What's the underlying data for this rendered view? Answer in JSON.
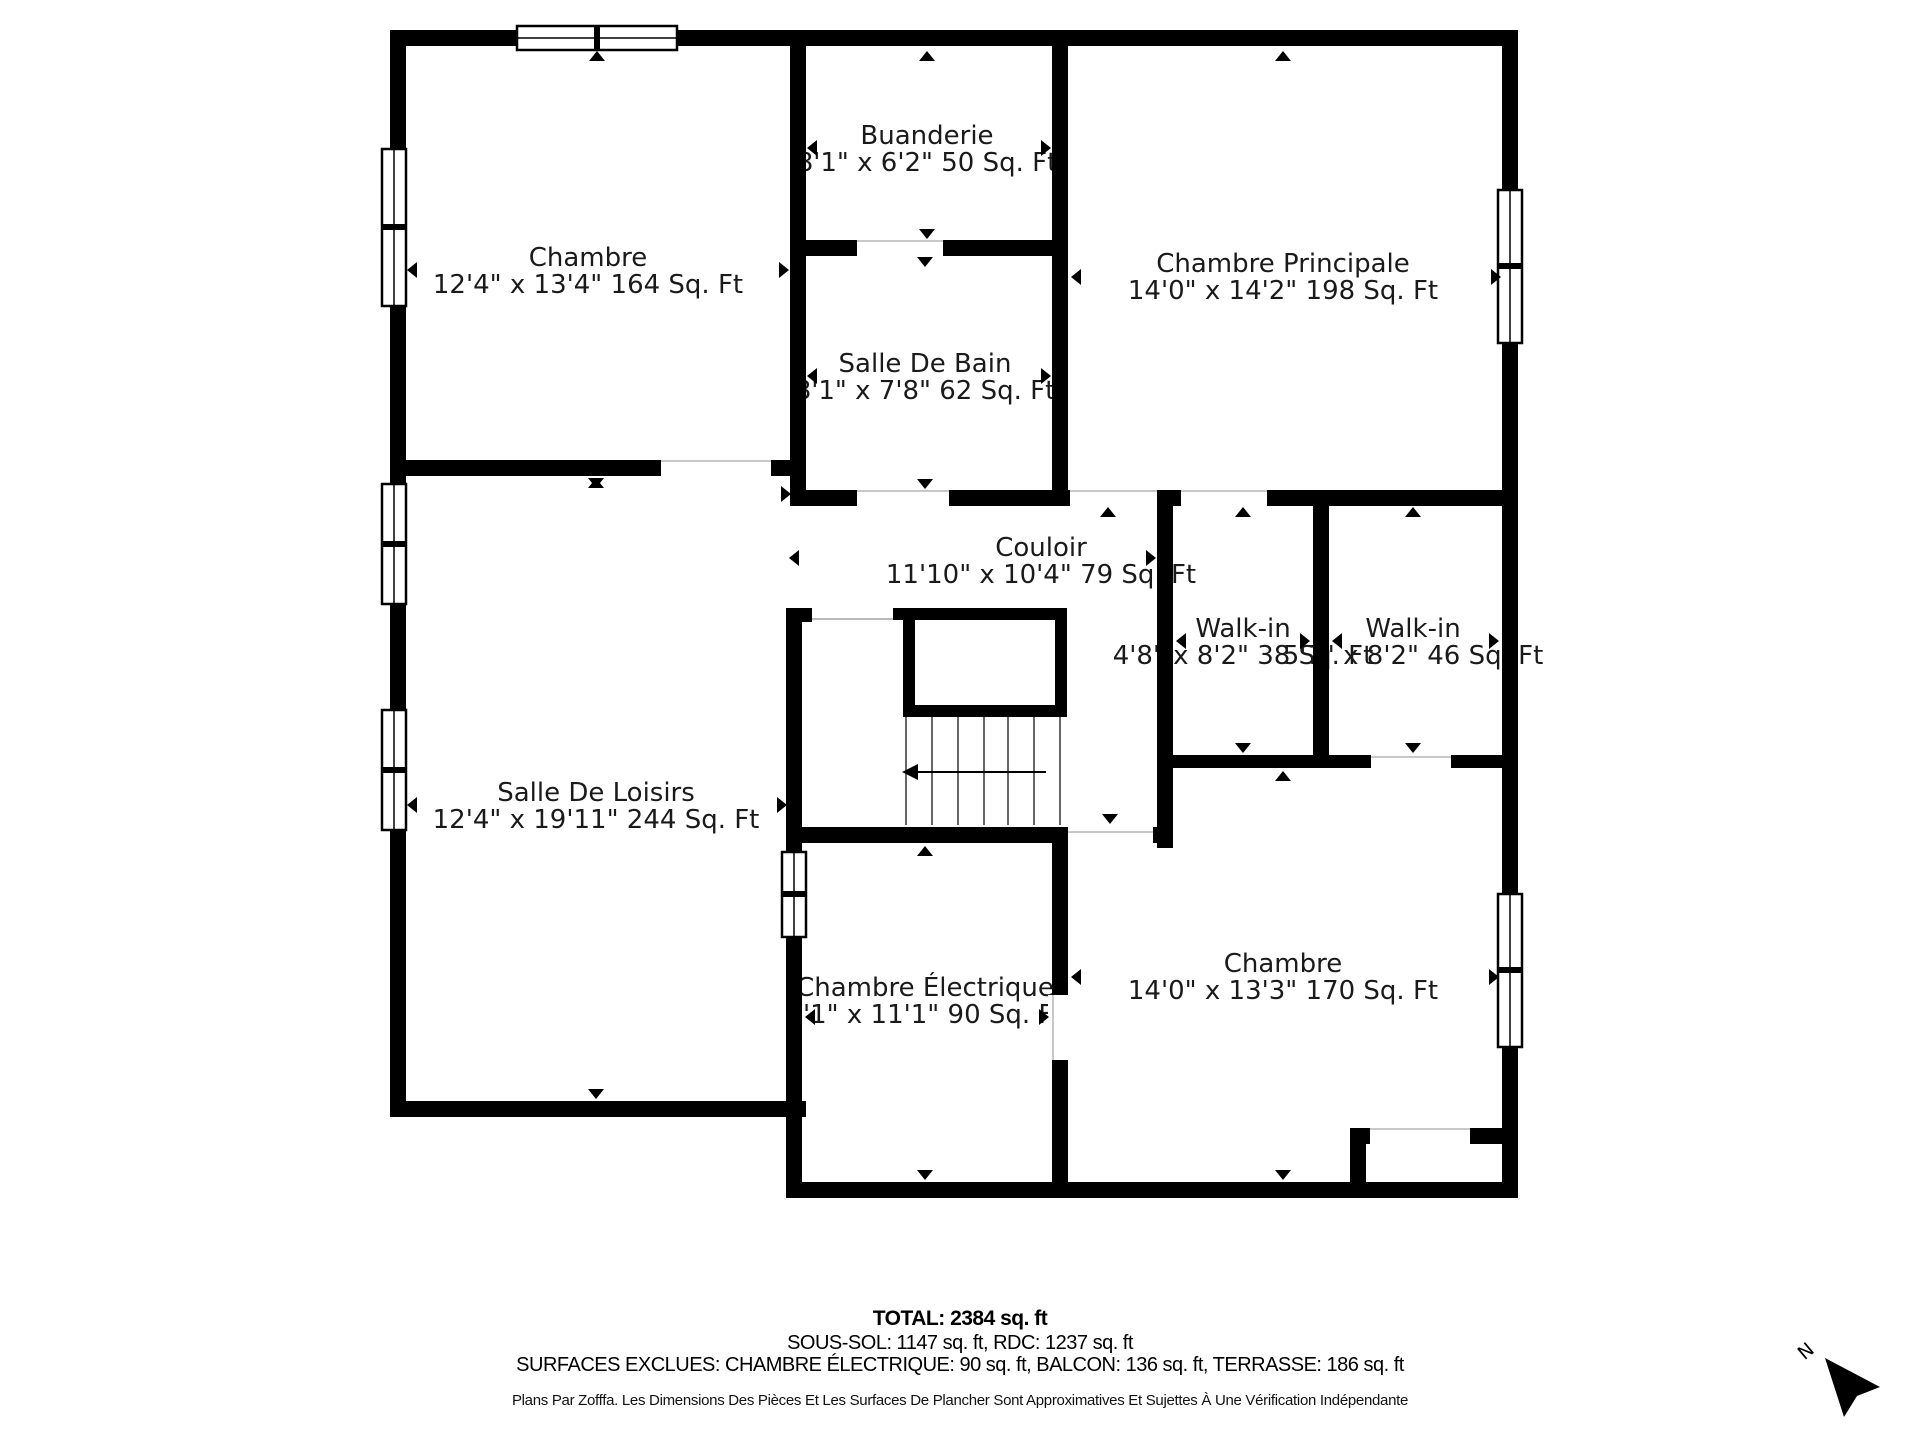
{
  "colors": {
    "wall": "#000000",
    "background": "#ffffff"
  },
  "rooms": [
    {
      "id": "chambre-top-left",
      "name": "Chambre",
      "dims": "12'4\" x 13'4\" 164 Sq. Ft"
    },
    {
      "id": "buanderie",
      "name": "Buanderie",
      "dims": "8'1\" x 6'2\" 50 Sq. Ft"
    },
    {
      "id": "salle-de-bain",
      "name": "Salle De Bain",
      "dims": "8'1\" x 7'8\" 62 Sq. Ft"
    },
    {
      "id": "chambre-principale",
      "name": "Chambre Principale",
      "dims": "14'0\" x 14'2\" 198 Sq. Ft"
    },
    {
      "id": "couloir",
      "name": "Couloir",
      "dims": "11'10\" x 10'4\" 79 Sq. Ft"
    },
    {
      "id": "walk-in-1",
      "name": "Walk-in",
      "dims": "4'8\" x 8'2\" 38 Sq. Ft"
    },
    {
      "id": "walk-in-2",
      "name": "Walk-in",
      "dims": "5'7\" x 8'2\" 46 Sq. Ft"
    },
    {
      "id": "salle-de-loisirs",
      "name": "Salle De Loisirs",
      "dims": "12'4\" x 19'11\" 244 Sq. Ft"
    },
    {
      "id": "chambre-electrique",
      "name": "Chambre Électrique",
      "dims": "8'1\" x 11'1\" 90 Sq. Ft"
    },
    {
      "id": "chambre-bottom-right",
      "name": "Chambre",
      "dims": "14'0\" x 13'3\" 170 Sq. Ft"
    }
  ],
  "footer": {
    "total": "TOTAL: 2384 sq. ft",
    "levels": "SOUS-SOL: 1147 sq. ft, RDC: 1237 sq. ft",
    "exclusions": "SURFACES EXCLUES: CHAMBRE ÉLECTRIQUE: 90 sq. ft, BALCON: 136 sq. ft, TERRASSE: 186 sq. ft",
    "disclaimer": "Plans Par Zofffa. Les Dimensions Des Pièces Et Les Surfaces De Plancher Sont Approximatives Et Sujettes À Une Vérification Indépendante"
  },
  "compass": {
    "label": "N"
  }
}
